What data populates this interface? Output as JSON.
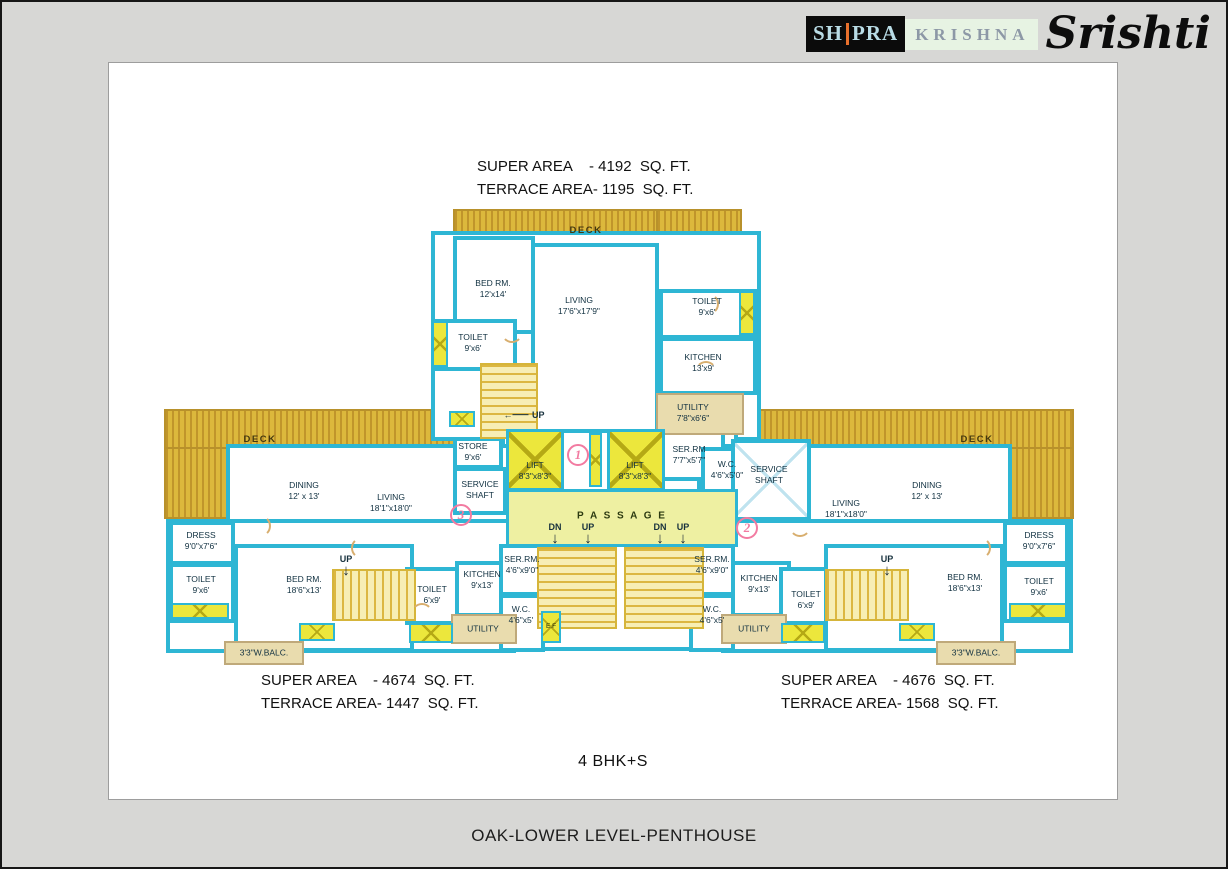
{
  "logo": {
    "part1": "SH",
    "part2": "PRA",
    "part3": "KRISHNA",
    "part4": "Srishti"
  },
  "title": "OAK-LOWER LEVEL-PENTHOUSE",
  "plan_type": "4 BHK+S",
  "areas": {
    "top": {
      "rows": [
        {
          "label": "SUPER AREA",
          "value": "- 4192  SQ. FT."
        },
        {
          "label": "TERRACE AREA",
          "value": "- 1195  SQ. FT."
        }
      ]
    },
    "left": {
      "rows": [
        {
          "label": "SUPER AREA",
          "value": "- 4674  SQ. FT."
        },
        {
          "label": "TERRACE AREA",
          "value": "- 1447  SQ. FT."
        }
      ]
    },
    "right": {
      "rows": [
        {
          "label": "SUPER AREA",
          "value": "- 4676  SQ. FT."
        },
        {
          "label": "TERRACE AREA",
          "value": "- 1568  SQ. FT."
        }
      ]
    }
  },
  "labels": {
    "deck": "DECK",
    "up": "UP",
    "dn": "DN",
    "ef": "E.F",
    "passage": "P A S S A G E"
  },
  "markers": {
    "m1": "1",
    "m2": "2",
    "m3": "3"
  },
  "rooms": {
    "bed_top": {
      "l1": "BED  RM.",
      "l2": "12'x14'"
    },
    "living_top": {
      "l1": "LIVING",
      "l2": "17'6\"x17'9\""
    },
    "toilet_top_l": {
      "l1": "TOILET",
      "l2": "9'x6'"
    },
    "toilet_top_r": {
      "l1": "TOILET",
      "l2": "9'x6'"
    },
    "kitchen_top": {
      "l1": "KITCHEN",
      "l2": "13'x9'"
    },
    "utility_top": {
      "l1": "UTILITY",
      "l2": "7'8\"x6'6\""
    },
    "store": {
      "l1": "STORE",
      "l2": "9'x6'"
    },
    "shaft_l": {
      "l1": "SERVICE",
      "l2": "SHAFT"
    },
    "shaft_r": {
      "l1": "SERVICE",
      "l2": "SHAFT"
    },
    "lift": {
      "l1": "LIFT",
      "l2": "8'3\"x8'3\""
    },
    "serrm_top": {
      "l1": "SER.RM",
      "l2": "7'7\"x5'7\""
    },
    "wc_top": {
      "l1": "W.C.",
      "l2": "4'6\"x5'0\""
    },
    "dining_l": {
      "l1": "DINING",
      "l2": "12'  x  13'"
    },
    "living_l": {
      "l1": "LIVING",
      "l2": "18'1\"x18'0\""
    },
    "dress_l": {
      "l1": "DRESS",
      "l2": "9'0\"x7'6\""
    },
    "toilet_far_l": {
      "l1": "TOILET",
      "l2": "9'x6'"
    },
    "bed_l": {
      "l1": "BED  RM.",
      "l2": "18'6\"x13'"
    },
    "toilet_mid_l": {
      "l1": "TOILET",
      "l2": "6'x9'"
    },
    "kitchen_l": {
      "l1": "KITCHEN",
      "l2": "9'x13'"
    },
    "utility_l": {
      "l1": "UTILITY",
      "l2": ""
    },
    "serrm_l": {
      "l1": "SER.RM.",
      "l2": "4'6\"x9'0\""
    },
    "wc_l": {
      "l1": "W.C.",
      "l2": "4'6\"x5'"
    },
    "wbalc_l": {
      "l1": "3'3\"W.BALC.",
      "l2": ""
    },
    "dining_r": {
      "l1": "DINING",
      "l2": "12'  x  13'"
    },
    "living_r": {
      "l1": "LIVING",
      "l2": "18'1\"x18'0\""
    },
    "dress_r": {
      "l1": "DRESS",
      "l2": "9'0\"x7'6\""
    },
    "toilet_far_r": {
      "l1": "TOILET",
      "l2": "9'x6'"
    },
    "bed_r": {
      "l1": "BED  RM.",
      "l2": "18'6\"x13'"
    },
    "toilet_mid_r": {
      "l1": "TOILET",
      "l2": "6'x9'"
    },
    "kitchen_r": {
      "l1": "KITCHEN",
      "l2": "9'x13'"
    },
    "utility_r": {
      "l1": "UTILITY",
      "l2": ""
    },
    "serrm_r": {
      "l1": "SER.RM.",
      "l2": "4'6\"x9'0\""
    },
    "wc_r": {
      "l1": "W.C.",
      "l2": "4'6\"x5'"
    },
    "wbalc_r": {
      "l1": "3'3\"W.BALC.",
      "l2": ""
    }
  },
  "colors": {
    "wall": "#2eb6d4",
    "deck": "#dcb83c",
    "lift": "#ece73c",
    "passage": "#eef0a2",
    "utility_tan": "#e9dcae",
    "marker_pink": "#f27ba1",
    "deck_edge_green": "#3fd0a0"
  }
}
